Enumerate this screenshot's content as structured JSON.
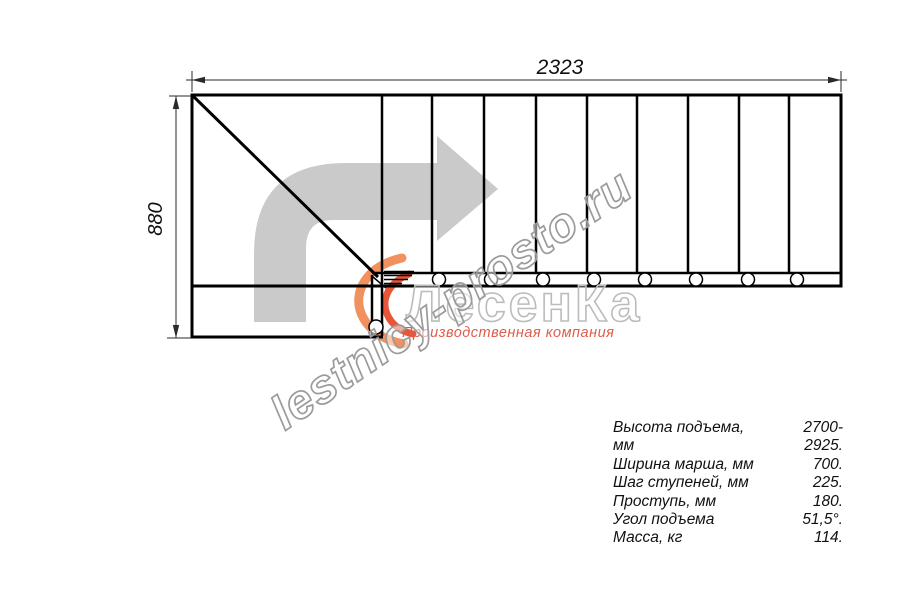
{
  "diagram": {
    "dimension_width_label": "2323",
    "dimension_height_label": "880",
    "tread_lines_x": [
      432,
      484,
      536,
      587,
      637,
      688,
      739,
      789
    ],
    "baluster_circles_x": [
      439,
      491,
      543,
      594,
      645,
      696,
      748,
      797
    ]
  },
  "branding": {
    "watermark_url": "lestnicy-prosto.ru",
    "logo_name": "ЛесенКа",
    "logo_tagline": "Производственная компания"
  },
  "specs": {
    "rows": [
      {
        "label": "Высота подъема, мм",
        "value": "2700-2925."
      },
      {
        "label": "Ширина марша, мм",
        "value": "700."
      },
      {
        "label": "Шаг ступеней, мм",
        "value": "225."
      },
      {
        "label": "Проступь, мм",
        "value": "180."
      },
      {
        "label": "Угол подъема",
        "value": "51,5°."
      },
      {
        "label": "Масса, кг",
        "value": "114."
      }
    ]
  },
  "colors": {
    "line_black": "#000000",
    "dimension_gray": "#2a2a2a",
    "arrow_gray": "#cacaca",
    "flame_orange_light": "#f0915e",
    "flame_orange_deep": "#e8563a",
    "logo_gray": "#bcbcbc",
    "watermark_gray": "#9b9b9b",
    "tagline_red": "#e05b4b"
  }
}
